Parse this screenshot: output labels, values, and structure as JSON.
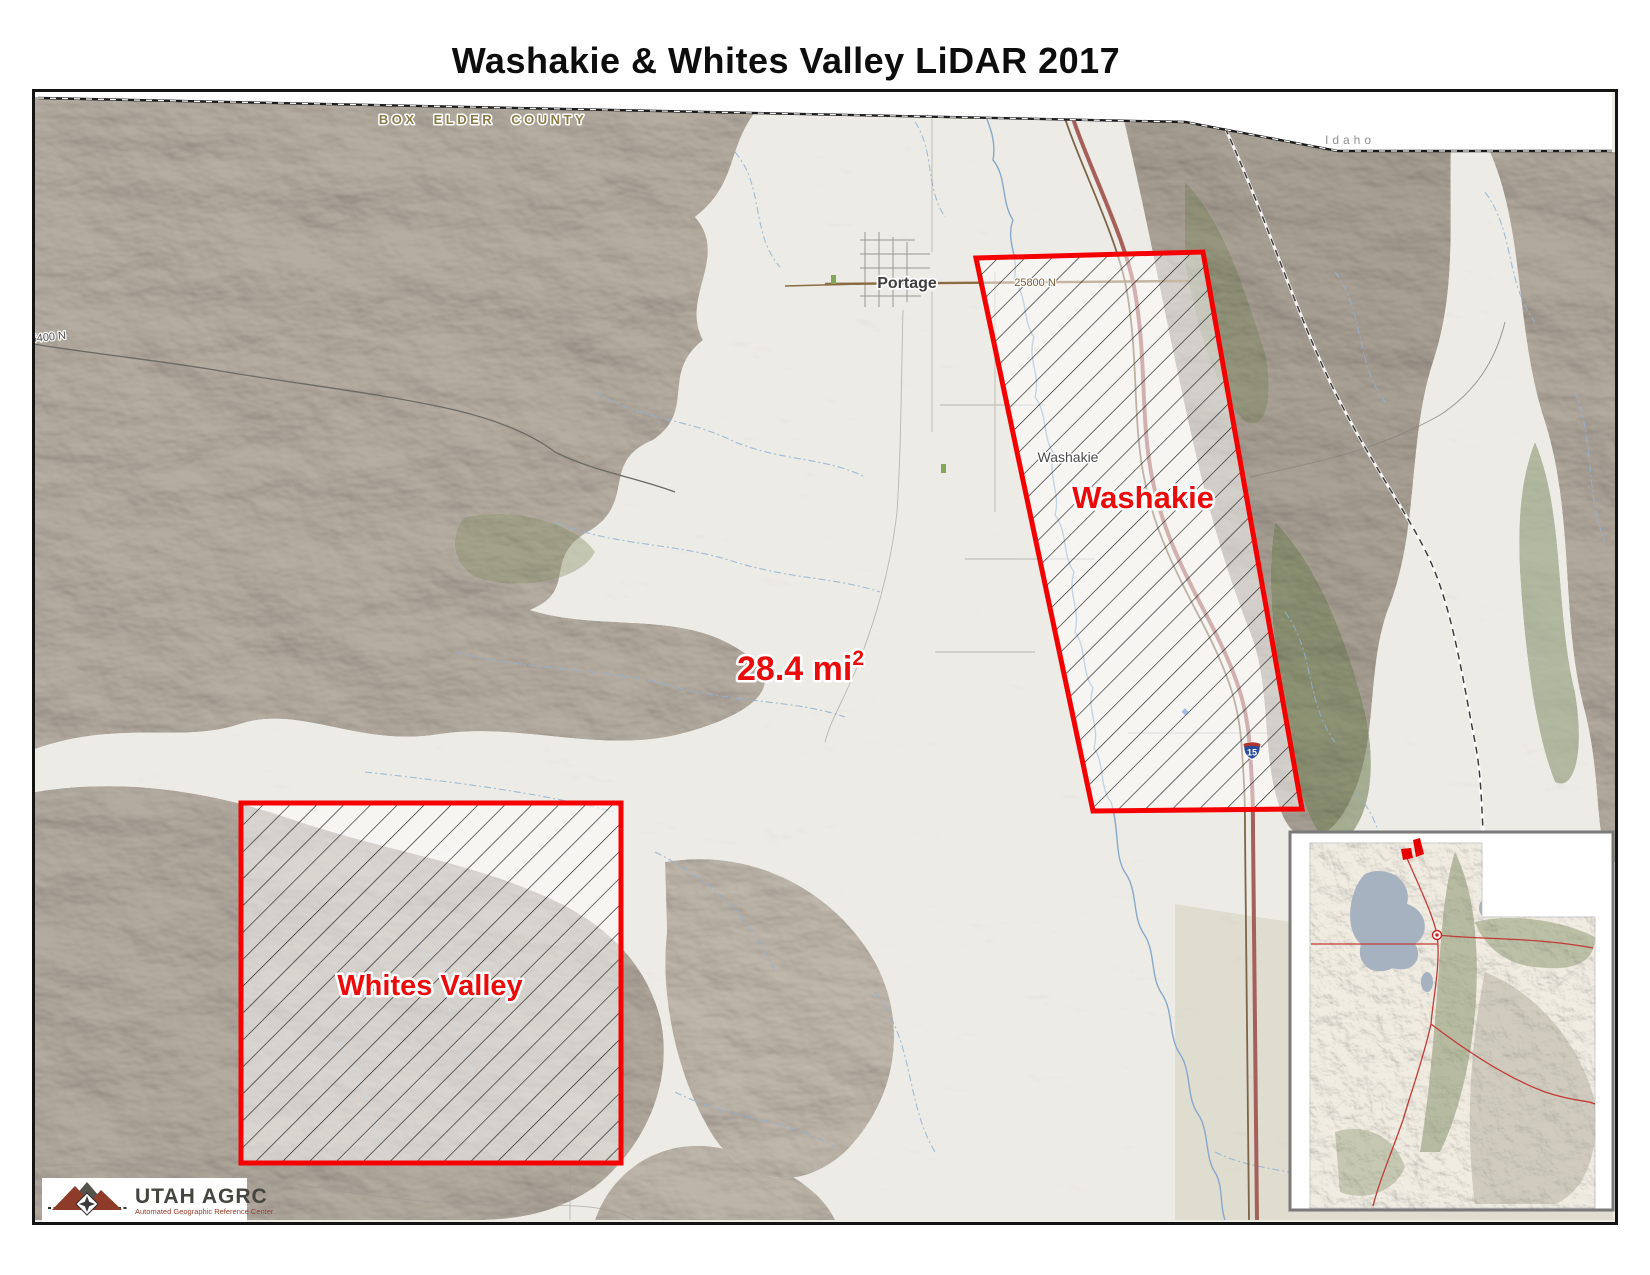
{
  "title": "Washakie & Whites Valley LiDAR 2017",
  "map": {
    "labels": {
      "county": "BOX ELDER COUNTY",
      "state": "Idaho",
      "area_value": "28.4 mi",
      "area_exponent": "2",
      "washakie_area": "Washakie",
      "whites_valley_area": "Whites Valley",
      "portage_town": "Portage",
      "washakie_town": "Washakie",
      "road_25800n": "25800 N",
      "road_5400n": "5400 N",
      "interstate_shield": "15"
    },
    "colors": {
      "polygon_outline": "#f40000",
      "label_red": "#ec0b0b",
      "terrain_gray": "#b3a99e",
      "terrain_green": "#7c8a5e",
      "stream_blue": "#8fb3d6",
      "highway_red": "#a5605a",
      "railroad_brown": "#7d6547",
      "county_label": "#8a7a45"
    }
  },
  "inset": {
    "highlight_color": "#cc2222"
  },
  "logo": {
    "title": "UTAH AGRC",
    "subtitle": "Automated Geographic Reference Center"
  }
}
